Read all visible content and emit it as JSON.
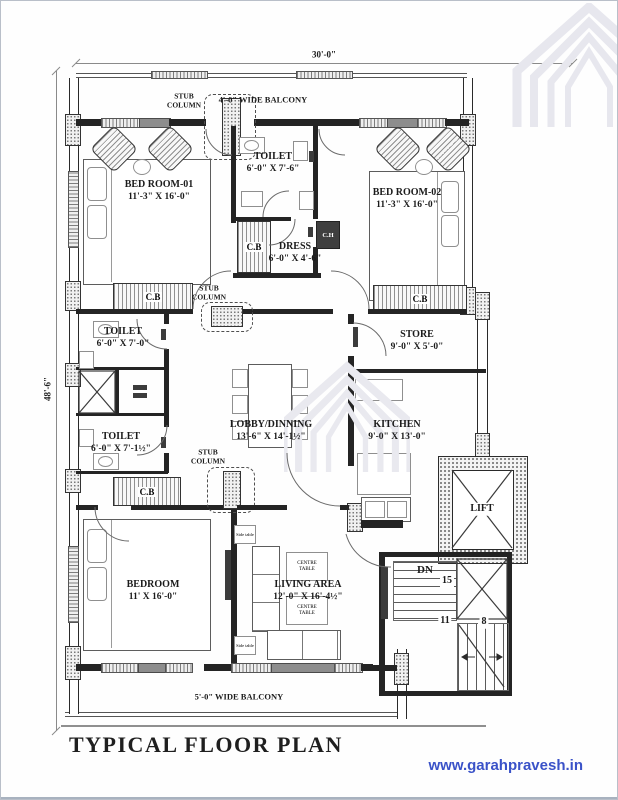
{
  "page": {
    "title": "TYPICAL FLOOR PLAN",
    "website": "www.garahpravesh.in",
    "website_color": "#3a52c8"
  },
  "dimensions": {
    "width": "30'-0\"",
    "height": "48'-6\""
  },
  "balconies": {
    "top": "4'-0\" WIDE BALCONY",
    "bottom": "5'-0\" WIDE BALCONY"
  },
  "rooms": {
    "bedroom1": {
      "name": "BED ROOM-01",
      "size": "11'-3\" X 16'-0\""
    },
    "toilet_top": {
      "name": "TOILET",
      "size": "6'-0\" X 7'-6\""
    },
    "dress": {
      "name": "DRESS",
      "size": "6'-0\" X 4'-6\""
    },
    "bedroom2": {
      "name": "BED ROOM-02",
      "size": "11'-3\" X 16'-0\""
    },
    "toilet_mid": {
      "name": "TOILET",
      "size": "6'-0\" X 7'-0\""
    },
    "toilet_low": {
      "name": "TOILET",
      "size": "6'-0\" X 7'-1½\""
    },
    "lobby": {
      "name": "LOBBY/DINNING",
      "size": "13'-6\" X 14'-1½\""
    },
    "store": {
      "name": "STORE",
      "size": "9'-0\" X 5'-0\""
    },
    "kitchen": {
      "name": "KITCHEN",
      "size": "9'-0\" X 13'-0\""
    },
    "lift": {
      "name": "LIFT"
    },
    "bedroom3": {
      "name": "BEDROOM",
      "size": "11' X 16'-0\""
    },
    "living": {
      "name": "LIVING AREA",
      "size": "12'-0\" X 16'-4½\""
    }
  },
  "annotations": {
    "stub_column": "STUB COLUMN",
    "cupboard": "C.B",
    "chest": "C.H",
    "down": "DN",
    "centre_table": "CENTRE TABLE",
    "side_table": "Side table",
    "stairs": {
      "flight1": "15",
      "flight2": "11",
      "flight3": "8"
    }
  }
}
